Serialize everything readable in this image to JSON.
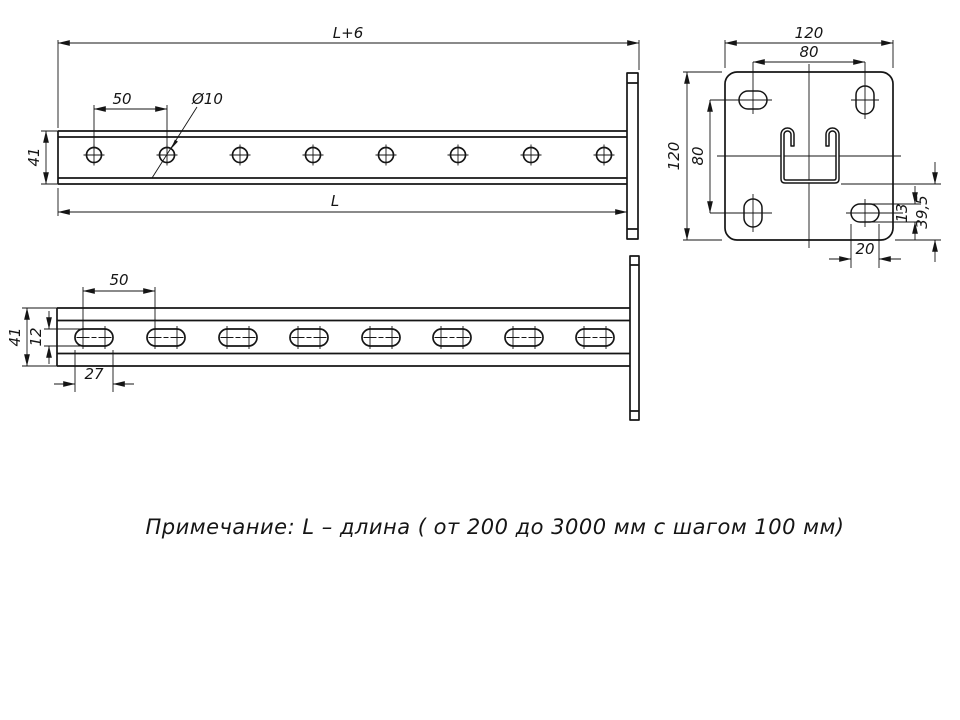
{
  "drawing": {
    "side_view": {
      "length_total": "L+6",
      "hole_pitch": "50",
      "hole_diameter": "Ø10",
      "height": "41",
      "length": "L"
    },
    "bottom_view": {
      "hole_pitch": "50",
      "height": "41",
      "slot_width": "12",
      "slot_length": "27"
    },
    "plate_view": {
      "width": "120",
      "hole_pitch_horizontal": "80",
      "height": "120",
      "hole_pitch_vertical": "80",
      "slot_width": "13",
      "slot_offset": "39,5",
      "slot_length": "20"
    },
    "note": "Примечание: L – длина ( от 200 до 3000 мм с шагом 100 мм)"
  }
}
